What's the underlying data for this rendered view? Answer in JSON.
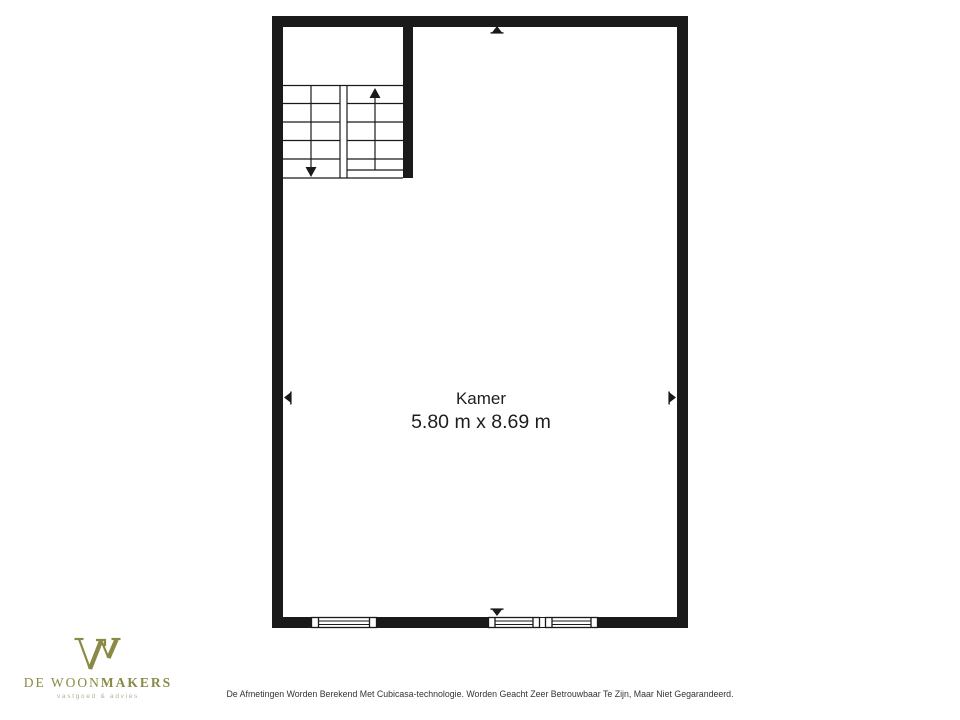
{
  "colors": {
    "background": "#ffffff",
    "wall": "#1a1a1a",
    "ink": "#1e1e1e",
    "brand": "#8a8a46",
    "brand_tagline": "#b3b39c",
    "disclaimer": "#333333"
  },
  "floorplan": {
    "room": {
      "name": "Kamer",
      "dimensions": "5.80 m x 8.69 m"
    },
    "stairs": {
      "left_flight_arrow": "down",
      "right_flight_arrow": "up"
    },
    "windows": [
      "window-bottom-left",
      "window-bottom-center",
      "window-bottom-right"
    ],
    "markers": [
      "wall-marker-top",
      "wall-marker-left",
      "wall-marker-right",
      "wall-marker-bottom"
    ]
  },
  "brand": {
    "name_regular": "DE WOON",
    "name_bold": "MAKERS",
    "tagline": "vastgoed & advies"
  },
  "footer": {
    "disclaimer": "De Afmetingen Worden Berekend Met Cubicasa-technologie. Worden Geacht Zeer Betrouwbaar Te Zijn, Maar Niet Gegarandeerd."
  }
}
